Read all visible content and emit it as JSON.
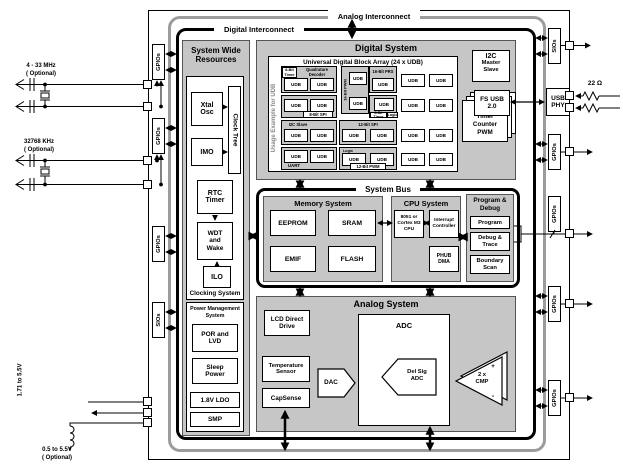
{
  "frame": {
    "analog_interconnect": "Analog Interconnect",
    "digital_interconnect": "Digital Interconnect"
  },
  "system_wide_resources": {
    "title": "System Wide\nResources",
    "clocking": {
      "caption": "Clocking System",
      "xtal_osc": "Xtal\nOsc",
      "clock_tree": "Clock Tree",
      "imo": "IMO",
      "rtc_timer": "RTC\nTimer",
      "wdt": "WDT\nand\nWake",
      "ilo": "ILO"
    },
    "power": {
      "caption": "Power Management\nSystem",
      "por_lvd": "POR and\nLVD",
      "sleep_power": "Sleep\nPower",
      "ldo": "1.8V LDO",
      "smp": "SMP"
    }
  },
  "digital_system": {
    "title": "Digital System",
    "udb_array": {
      "title": "Universal Digital Block Array (24 x UDB)",
      "side_label": "Usage Example for UDB",
      "udb": "UDB",
      "labels": {
        "timer8_1": "8-Bit\nTimer",
        "quadrature": "Quadrature Decoder",
        "pwm16": "16-Bit PWM",
        "prs16": "16-Bit PRS",
        "spi8": "8-Bit SPI",
        "timer8_2": "8-Bit Timer",
        "logic1": "Logic",
        "i2c_slave": "I2C Slave",
        "spi12": "12-Bit SPI",
        "uart": "UART",
        "logic2": "Logic",
        "pwm12": "12-Bit PWM"
      }
    },
    "timer_counter_pwm": "4 x\nTimer\nCounter\nPWM",
    "i2c_master_slave_title": "I2C",
    "i2c_master_slave_sub": "Master\nSlave",
    "fs_usb": "FS USB\n2.0"
  },
  "system_bus": {
    "title": "System Bus",
    "memory": {
      "title": "Memory System",
      "eeprom": "EEPROM",
      "sram": "SRAM",
      "emif": "EMIF",
      "flash": "FLASH"
    },
    "cpu": {
      "title": "CPU System",
      "core": "8051 or\nCortex M3\nCPU",
      "interrupt": "Interrupt\nController",
      "phub_dma": "PHUB\nDMA"
    },
    "program_debug": {
      "title": "Program &\nDebug",
      "program": "Program",
      "debug_trace": "Debug &\nTrace",
      "boundary_scan": "Boundary\nScan"
    }
  },
  "analog_system": {
    "title": "Analog System",
    "lcd": "LCD Direct\nDrive",
    "adc": "ADC",
    "del_sig": "Del Sig\nADC",
    "temp_sensor": "Temperature\nSensor",
    "dac": "DAC",
    "capsense": "CapSense",
    "cmp": "2 x\nCMP",
    "plus": "+",
    "minus": "-"
  },
  "usb_phy": "USB\nPHY",
  "pins": {
    "gpio": "GPIOs",
    "sio": "SIOs"
  },
  "externals": {
    "xtal_mhz": "4 - 33 MHz\n( Optional)",
    "xtal_khz": "32768  KHz\n( Optional)",
    "vdd_range": "1.71 to\n5.5V",
    "smp_range": "0.5 to 5.5V\n( Optional)",
    "usb_resistor": "22 Ω"
  }
}
